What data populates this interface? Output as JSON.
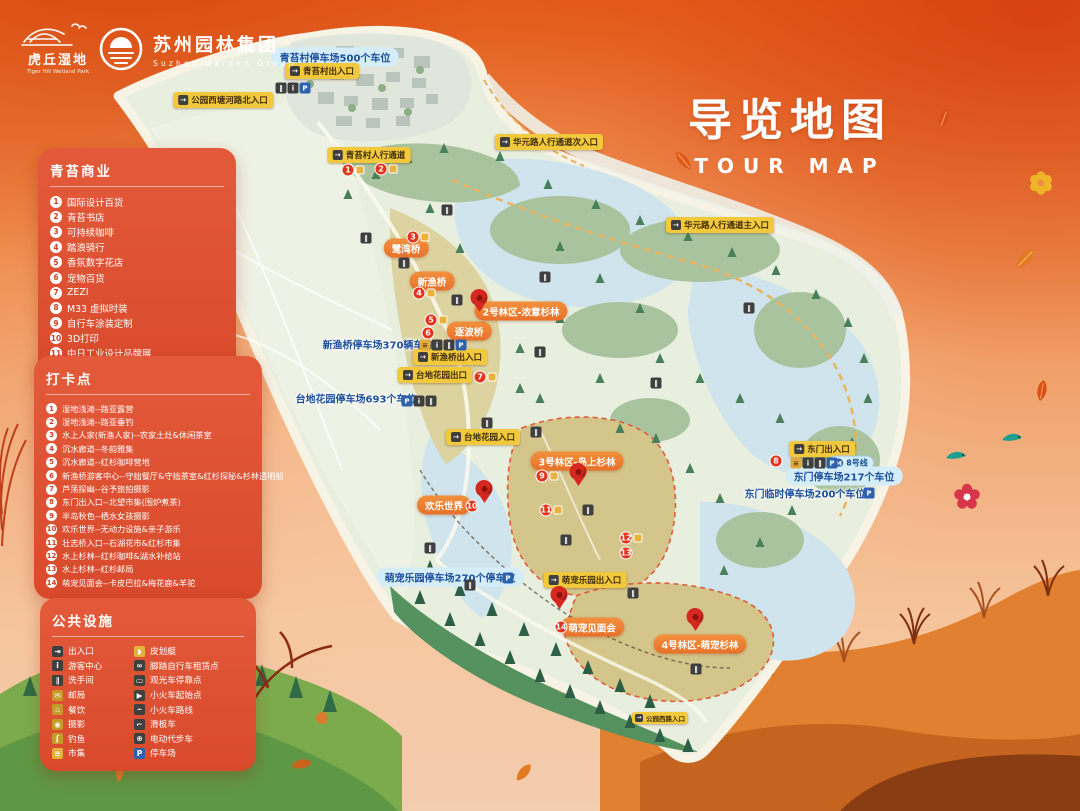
{
  "header": {
    "park_logo": {
      "name": "虎丘湿地",
      "en": "Tiger Hill Wetland Park"
    },
    "group_logo": {
      "name": "苏州园林集团",
      "en": "Suzhou Garden Group"
    },
    "title": {
      "cn": "导览地图",
      "en": "TOUR MAP"
    }
  },
  "panels": {
    "shops": {
      "title": "青苔商业",
      "items": [
        "国际设计百货",
        "青苔书店",
        "可持续咖啡",
        "踏浪骑行",
        "香氛数字花店",
        "宠物百货",
        "ZEZI",
        "M33 虚拟时装",
        "自行车涂装定制",
        "3D打印",
        "中日工业设计品牌展",
        "中日工业设计中心展厅"
      ]
    },
    "checkins": {
      "title": "打卡点",
      "items": [
        "湿地浅滩--路亚露营",
        "湿地浅滩--路亚垂钓",
        "水上人家(新渔人家)--农家土灶&休闲茶室",
        "沉水廊道--冬韵雅集",
        "沉水廊道--红杉咖啡营地",
        "新渔桥游客中心--守拙餐厅&守拙茶室&红杉探秘&杉林透明船",
        "芦荡探幽--谷予旅拍摄影",
        "东门出入口--北望市集(围炉煮茶)",
        "半岛秋色--栖水女孩摄影",
        "欢乐世界--无动力设施&亲子游乐",
        "壮志桥入口--石湖花市&红杉市集",
        "水上杉林--红杉咖啡&湖水补给站",
        "水上杉林--红杉邮局",
        "萌宠见面会--卡皮巴拉&梅花鹿&羊驼"
      ]
    },
    "facilities": {
      "title": "公共设施",
      "left": [
        {
          "label": "出入口",
          "icon": "entrance-icon",
          "glyph": "⇥",
          "bg": "#3f3f3f"
        },
        {
          "label": "游客中心",
          "icon": "visitor-center-icon",
          "glyph": "i",
          "bg": "#3f3f3f"
        },
        {
          "label": "洗手间",
          "icon": "restroom-icon",
          "glyph": "∥",
          "bg": "#3f3f3f"
        },
        {
          "label": "邮局",
          "icon": "post-office-icon",
          "glyph": "✉",
          "bg": "#c59a28"
        },
        {
          "label": "餐饮",
          "icon": "dining-icon",
          "glyph": "♨",
          "bg": "#c59a28"
        },
        {
          "label": "摄影",
          "icon": "photography-icon",
          "glyph": "◉",
          "bg": "#c59a28"
        },
        {
          "label": "钓鱼",
          "icon": "fishing-icon",
          "glyph": "ʃ",
          "bg": "#c59a28"
        },
        {
          "label": "市集",
          "icon": "market-icon",
          "glyph": "≡",
          "bg": "#e2b23a"
        }
      ],
      "right": [
        {
          "label": "皮划艇",
          "icon": "kayak-icon",
          "glyph": "◗",
          "bg": "#e2b23a"
        },
        {
          "label": "脚踏自行车租赁点",
          "icon": "bike-rental-icon",
          "glyph": "∞",
          "bg": "#3f3f3f"
        },
        {
          "label": "观光车停靠点",
          "icon": "sightseeing-bus-stop-icon",
          "glyph": "▭",
          "bg": "#3f3f3f"
        },
        {
          "label": "小火车起始点",
          "icon": "train-start-icon",
          "glyph": "▶",
          "bg": "#3f3f3f"
        },
        {
          "label": "小火车路线",
          "icon": "train-route-icon",
          "glyph": "┅",
          "bg": "#3f3f3f"
        },
        {
          "label": "滑板车",
          "icon": "scooter-icon",
          "glyph": "⌐",
          "bg": "#3f3f3f"
        },
        {
          "label": "电动代步车",
          "icon": "mobility-cart-icon",
          "glyph": "⊕",
          "bg": "#3f3f3f"
        },
        {
          "label": "停车场",
          "icon": "parking-icon",
          "glyph": "P",
          "bg": "#2e62b0"
        }
      ]
    }
  },
  "map": {
    "compass_label": "N",
    "icon_defs": {
      "entrance": {
        "g": "→",
        "bg": "#3f3f3f"
      },
      "info": {
        "g": "i",
        "bg": "#3f3f3f"
      },
      "wc": {
        "g": "∥",
        "bg": "#3f3f3f"
      },
      "parking": {
        "g": "P",
        "bg": "#2e62b0"
      },
      "ticket": {
        "g": "≡",
        "bg": "#e2a93b",
        "fg": "#4a3405"
      },
      "metro": {
        "g": "M",
        "bg": "#2e62b0"
      }
    },
    "labels": [
      {
        "type": "bluepill",
        "text": "青苔村停车场500个车位",
        "x": 335,
        "y": 57
      },
      {
        "type": "yellow",
        "text": "青苔村出入口",
        "x": 322,
        "y": 71
      },
      {
        "type": "yellow",
        "text": "公园西塘河路北入口",
        "x": 223,
        "y": 100
      },
      {
        "type": "yellow",
        "text": "青苔村人行通道",
        "x": 369,
        "y": 155
      },
      {
        "type": "yellow",
        "text": "华元路人行通道次入口",
        "x": 549,
        "y": 142
      },
      {
        "type": "yellow",
        "text": "华元路人行通道主入口",
        "x": 720,
        "y": 225
      },
      {
        "type": "orange",
        "text": "鹭湾桥",
        "x": 406,
        "y": 248
      },
      {
        "type": "orange",
        "text": "新渔桥",
        "x": 432,
        "y": 281
      },
      {
        "type": "orange",
        "text": "逐波桥",
        "x": 469,
        "y": 331
      },
      {
        "type": "orange",
        "text": "2号林区-浓意杉林",
        "x": 521,
        "y": 311
      },
      {
        "type": "bluetext",
        "text": "新渔桥停车场370辆车位",
        "x": 378,
        "y": 344
      },
      {
        "type": "yellow",
        "text": "新渔桥出入口",
        "x": 450,
        "y": 357
      },
      {
        "type": "yellow",
        "text": "台地花园出口",
        "x": 435,
        "y": 375
      },
      {
        "type": "bluetext",
        "text": "台地花园停车场693个车位",
        "x": 356,
        "y": 398
      },
      {
        "type": "yellow",
        "text": "台地花园入口",
        "x": 483,
        "y": 437
      },
      {
        "type": "orange",
        "text": "3号林区-岛上杉林",
        "x": 577,
        "y": 461
      },
      {
        "type": "orange",
        "text": "欢乐世界",
        "x": 444,
        "y": 505
      },
      {
        "type": "yellow",
        "text": "东门出入口",
        "x": 822,
        "y": 449
      },
      {
        "type": "metro",
        "text": "8号线",
        "x": 851,
        "y": 463
      },
      {
        "type": "bluepill",
        "text": "东门停车场217个车位",
        "x": 844,
        "y": 476
      },
      {
        "type": "bluetext",
        "text": "东门临时停车场200个车位",
        "x": 805,
        "y": 493
      },
      {
        "type": "bluepill",
        "text": "萌宠乐园停车场270个停车位",
        "x": 450,
        "y": 577
      },
      {
        "type": "yellow",
        "text": "萌宠乐园出入口",
        "x": 585,
        "y": 580
      },
      {
        "type": "orange",
        "text": "萌宠见面会",
        "x": 592,
        "y": 627
      },
      {
        "type": "orange",
        "text": "4号林区-萌宠杉林",
        "x": 700,
        "y": 644
      },
      {
        "type": "yellow-sm",
        "text": "公园西路入口",
        "x": 660,
        "y": 718
      }
    ],
    "pins": [
      {
        "x": 479,
        "y": 306
      },
      {
        "x": 578,
        "y": 480
      },
      {
        "x": 484,
        "y": 497
      },
      {
        "x": 559,
        "y": 603
      },
      {
        "x": 695,
        "y": 625
      }
    ],
    "numbers": [
      {
        "n": "1",
        "x": 348,
        "y": 170,
        "sq": true
      },
      {
        "n": "2",
        "x": 381,
        "y": 169,
        "sq": true
      },
      {
        "n": "3",
        "x": 413,
        "y": 237,
        "sq": true
      },
      {
        "n": "4",
        "x": 419,
        "y": 293,
        "sq": true
      },
      {
        "n": "5",
        "x": 431,
        "y": 320,
        "sq": true
      },
      {
        "n": "6",
        "x": 428,
        "y": 333
      },
      {
        "n": "7",
        "x": 480,
        "y": 377,
        "sq": true
      },
      {
        "n": "8",
        "x": 776,
        "y": 461
      },
      {
        "n": "9",
        "x": 542,
        "y": 476,
        "sq": true
      },
      {
        "n": "10",
        "x": 472,
        "y": 506
      },
      {
        "n": "11",
        "x": 546,
        "y": 510,
        "sq": true
      },
      {
        "n": "12",
        "x": 626,
        "y": 538,
        "sq": true
      },
      {
        "n": "13",
        "x": 626,
        "y": 553
      },
      {
        "n": "14",
        "x": 561,
        "y": 627
      }
    ],
    "icon_groups": [
      {
        "x": 293,
        "y": 88,
        "icons": [
          "wc",
          "info",
          "parking"
        ]
      },
      {
        "x": 443,
        "y": 345,
        "icons": [
          "ticket",
          "info",
          "wc",
          "parking"
        ]
      },
      {
        "x": 419,
        "y": 401,
        "icons": [
          "parking",
          "info",
          "wc"
        ]
      },
      {
        "x": 814,
        "y": 463,
        "icons": [
          "ticket",
          "info",
          "wc",
          "parking"
        ]
      }
    ],
    "parking_icons": [
      {
        "x": 508,
        "y": 578
      },
      {
        "x": 869,
        "y": 493
      }
    ],
    "wc_spots": [
      [
        366,
        238
      ],
      [
        404,
        263
      ],
      [
        447,
        210
      ],
      [
        545,
        277
      ],
      [
        656,
        383
      ],
      [
        487,
        423
      ],
      [
        536,
        432
      ],
      [
        566,
        540
      ],
      [
        588,
        510
      ],
      [
        430,
        548
      ],
      [
        470,
        585
      ],
      [
        633,
        593
      ],
      [
        696,
        669
      ],
      [
        540,
        352
      ],
      [
        457,
        300
      ],
      [
        749,
        308
      ]
    ]
  },
  "colors": {
    "background_orange": "#e8641f",
    "panel_red": "#dd5132",
    "label_yellow": "#f2c83c",
    "label_orange": "#ee7f2e",
    "parking_blue": "#1c4f9c",
    "pin_red": "#d6281e",
    "map_green": "#e9efdf",
    "water_blue": "#cfe4ec"
  }
}
